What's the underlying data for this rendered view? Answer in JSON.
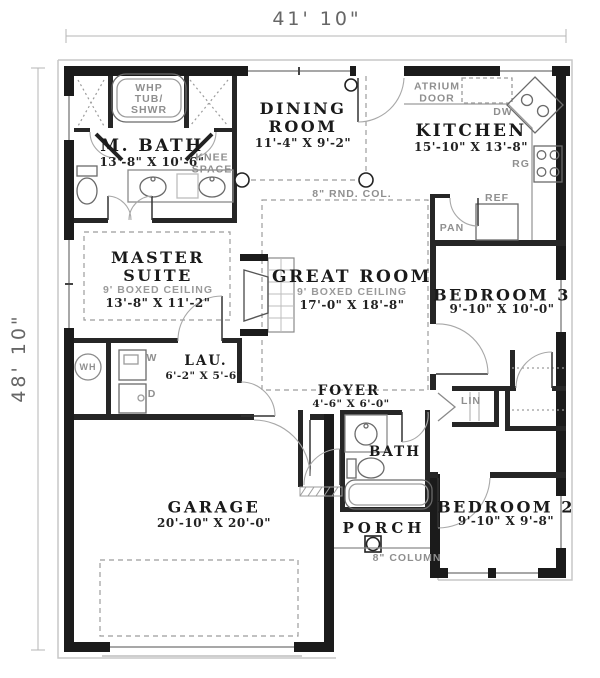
{
  "plan": {
    "overall": {
      "width_dim": "41' 10\"",
      "height_dim": "48' 10\""
    },
    "rooms": {
      "m_bath": {
        "name": "M. BATH",
        "dims": "13'-8\" X 10'-6\""
      },
      "dining": {
        "name": "DINING ROOM",
        "dims": "11'-4\" X 9'-2\""
      },
      "kitchen": {
        "name": "KITCHEN",
        "dims": "15'-10\" X 13'-8\""
      },
      "master": {
        "name": "MASTER SUITE",
        "ceiling": "9' BOXED CEILING",
        "dims": "13'-8\" X 11'-2\""
      },
      "great": {
        "name": "GREAT ROOM",
        "ceiling": "9' BOXED CEILING",
        "dims": "17'-0\" X 18'-8\""
      },
      "bedroom3": {
        "name": "BEDROOM 3",
        "dims": "9'-10\" X 10'-0\""
      },
      "laundry": {
        "name": "LAU.",
        "dims": "6'-2\" X 5'-6\""
      },
      "foyer": {
        "name": "FOYER",
        "dims": "4'-6\" X 6'-0\""
      },
      "bath": {
        "name": "BATH"
      },
      "garage": {
        "name": "GARAGE",
        "dims": "20'-10\" X 20'-0\""
      },
      "porch": {
        "name": "PORCH"
      },
      "bedroom2": {
        "name": "BEDROOM 2",
        "dims": "9'-10\" X 9'-8\""
      }
    },
    "fixtures": {
      "tub_l1": "WHP",
      "tub_l2": "TUB/",
      "tub_l3": "SHWR",
      "knee_space": "KNEE SPACE",
      "atrium_door": "ATRIUM DOOR",
      "dw": "DW",
      "rg": "RG",
      "ref": "REF",
      "pan": "PAN",
      "lin": "LIN",
      "wh": "WH",
      "washer": "W",
      "dryer": "D"
    },
    "annotations": {
      "round_col": "8\" RND. COL.",
      "porch_col": "8\" COLUMN"
    },
    "colors": {
      "wall": "#1b1b1b",
      "thin_line": "#8a8a8a",
      "dashed": "#9c9c9c",
      "text": "#1a1a1a"
    }
  }
}
